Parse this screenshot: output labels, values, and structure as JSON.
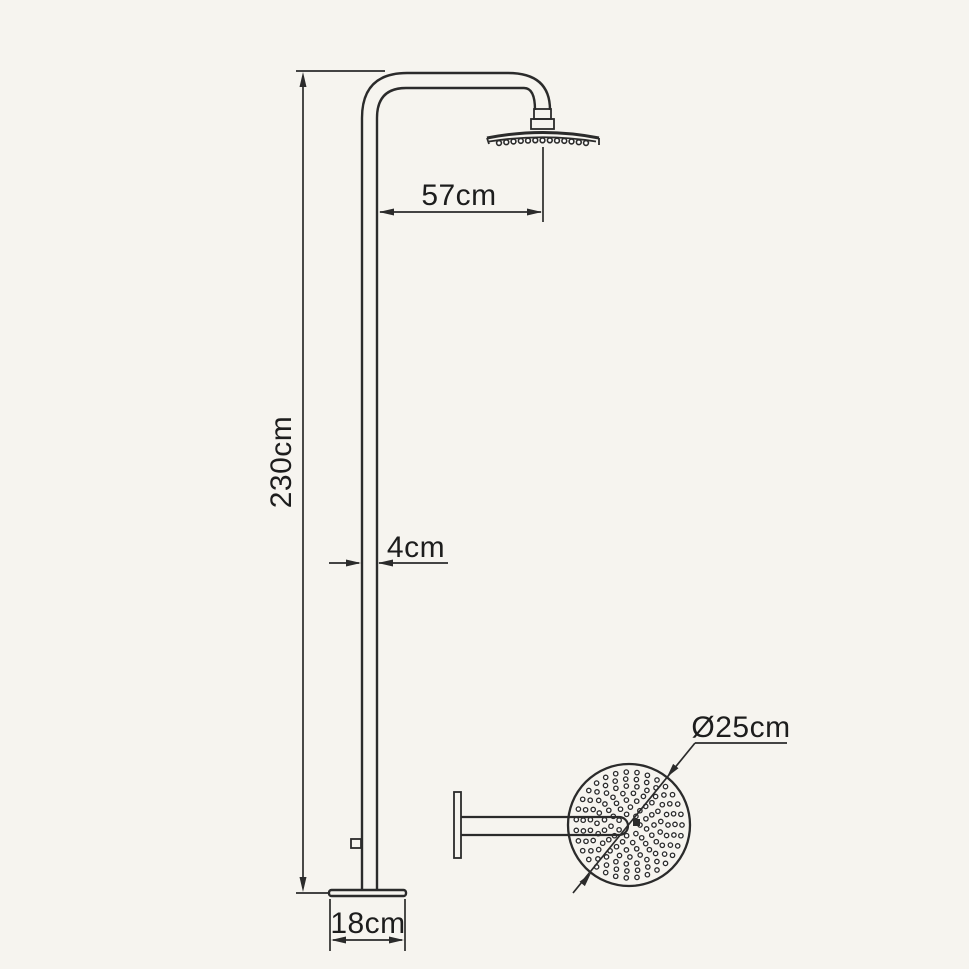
{
  "drawing": {
    "type": "technical-dimension-drawing",
    "subject": "freestanding shower column with round rain head",
    "labels": {
      "total_height": "230cm",
      "arm_length": "57cm",
      "pipe_width": "4cm",
      "base_width": "18cm",
      "head_diameter": "Ø25cm"
    },
    "colors": {
      "background": "#f6f4ef",
      "line": "#2b2b2b",
      "text": "#1d1d1d",
      "fill_white": "#fcfbf8"
    }
  }
}
